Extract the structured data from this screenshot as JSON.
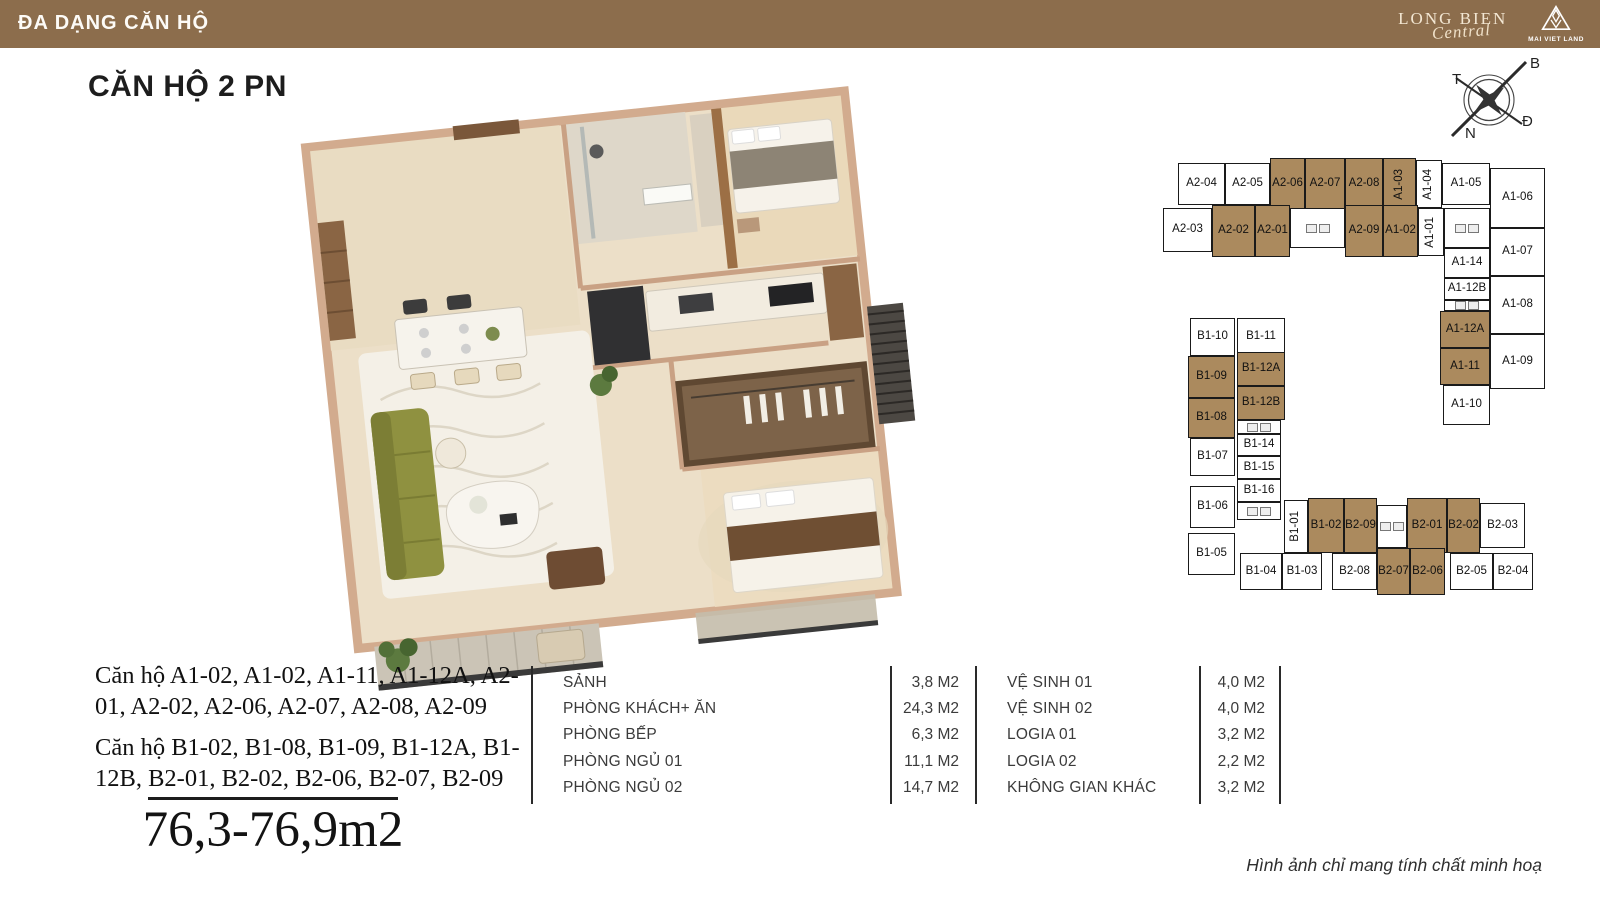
{
  "header": {
    "title": "ĐA DẠNG CĂN HỘ",
    "logo": {
      "line1": "LONG BIEN",
      "line2": "Central",
      "brand": "MAI VIET LAND"
    }
  },
  "page": {
    "title": "CĂN HỘ 2 PN",
    "area_range": "76,3-76,9m2",
    "disclaimer": "Hình ảnh chỉ mang tính chất minh hoạ"
  },
  "unit_groups": [
    {
      "text": "Căn hộ A1-02, A1-02, A1-11, A1-12A, A2-01, A2-02, A2-06, A2-07, A2-08, A2-09"
    },
    {
      "text": "Căn hộ B1-02, B1-08, B1-09, B1-12A, B1-12B, B2-01, B2-02, B2-06, B2-07, B2-09"
    }
  ],
  "compass": {
    "top": "B",
    "left": "T",
    "bottom": "N",
    "right": "Đ"
  },
  "room_table": {
    "left": [
      {
        "label": "SẢNH",
        "area": "3,8 M2"
      },
      {
        "label": "PHÒNG KHÁCH+ ĂN",
        "area": "24,3 M2"
      },
      {
        "label": "PHÒNG BẾP",
        "area": "6,3 M2"
      },
      {
        "label": "PHÒNG NGỦ 01",
        "area": "11,1 M2"
      },
      {
        "label": "PHÒNG NGỦ 02",
        "area": "14,7 M2"
      }
    ],
    "right": [
      {
        "label": "VỆ SINH 01",
        "area": "4,0 M2"
      },
      {
        "label": "VỆ SINH 02",
        "area": "4,0 M2"
      },
      {
        "label": "LOGIA 01",
        "area": "3,2 M2"
      },
      {
        "label": "LOGIA 02",
        "area": "2,2 M2"
      },
      {
        "label": "KHÔNG GIAN KHÁC",
        "area": "3,2 M2"
      }
    ]
  },
  "colors": {
    "header_bg": "#8c6d4c",
    "unit_highlight": "#ab8a5e",
    "unit_border": "#1a1a1a"
  },
  "floorplate": {
    "highlight_color": "#ab8a5e",
    "units": [
      {
        "label": "A2-04",
        "x": 28,
        "y": 13,
        "w": 47,
        "h": 42
      },
      {
        "label": "A2-05",
        "x": 75,
        "y": 13,
        "w": 45,
        "h": 42
      },
      {
        "label": "A2-06",
        "x": 120,
        "y": 8,
        "w": 35,
        "h": 52,
        "hl": true
      },
      {
        "label": "A2-07",
        "x": 155,
        "y": 8,
        "w": 40,
        "h": 52,
        "hl": true
      },
      {
        "label": "A2-08",
        "x": 195,
        "y": 8,
        "w": 38,
        "h": 52,
        "hl": true
      },
      {
        "label": "A1-03",
        "x": 233,
        "y": 8,
        "w": 33,
        "h": 52,
        "hl": true,
        "v": true
      },
      {
        "label": "A1-04",
        "x": 266,
        "y": 10,
        "w": 26,
        "h": 48,
        "v": true
      },
      {
        "label": "A1-05",
        "x": 292,
        "y": 13,
        "w": 48,
        "h": 42
      },
      {
        "label": "A2-03",
        "x": 13,
        "y": 58,
        "w": 49,
        "h": 44
      },
      {
        "label": "A2-02",
        "x": 62,
        "y": 55,
        "w": 43,
        "h": 52,
        "hl": true
      },
      {
        "label": "A2-01",
        "x": 105,
        "y": 55,
        "w": 35,
        "h": 52,
        "hl": true
      },
      {
        "label": "",
        "x": 140,
        "y": 58,
        "w": 55,
        "h": 40,
        "core": true
      },
      {
        "label": "A2-09",
        "x": 195,
        "y": 55,
        "w": 38,
        "h": 52,
        "hl": true
      },
      {
        "label": "A1-02",
        "x": 233,
        "y": 55,
        "w": 35,
        "h": 52,
        "hl": true
      },
      {
        "label": "A1-01",
        "x": 268,
        "y": 58,
        "w": 26,
        "h": 48,
        "v": true
      },
      {
        "label": "",
        "x": 294,
        "y": 58,
        "w": 46,
        "h": 40,
        "core": true
      },
      {
        "label": "A1-06",
        "x": 340,
        "y": 18,
        "w": 55,
        "h": 60
      },
      {
        "label": "A1-07",
        "x": 340,
        "y": 78,
        "w": 55,
        "h": 48
      },
      {
        "label": "A1-14",
        "x": 294,
        "y": 98,
        "w": 46,
        "h": 30
      },
      {
        "label": "A1-12B",
        "x": 294,
        "y": 128,
        "w": 46,
        "h": 22
      },
      {
        "label": "A1-08",
        "x": 340,
        "y": 126,
        "w": 55,
        "h": 58
      },
      {
        "label": "",
        "x": 294,
        "y": 150,
        "w": 46,
        "h": 11,
        "core": true
      },
      {
        "label": "A1-12A",
        "x": 290,
        "y": 161,
        "w": 50,
        "h": 37,
        "hl": true
      },
      {
        "label": "A1-11",
        "x": 290,
        "y": 198,
        "w": 50,
        "h": 37,
        "hl": true
      },
      {
        "label": "A1-09",
        "x": 340,
        "y": 184,
        "w": 55,
        "h": 55
      },
      {
        "label": "A1-10",
        "x": 293,
        "y": 235,
        "w": 47,
        "h": 40
      },
      {
        "label": "B1-10",
        "x": 40,
        "y": 168,
        "w": 45,
        "h": 38
      },
      {
        "label": "B1-11",
        "x": 87,
        "y": 168,
        "w": 48,
        "h": 38
      },
      {
        "label": "B1-09",
        "x": 38,
        "y": 206,
        "w": 47,
        "h": 42,
        "hl": true
      },
      {
        "label": "B1-12A",
        "x": 87,
        "y": 202,
        "w": 48,
        "h": 34,
        "hl": true
      },
      {
        "label": "B1-12B",
        "x": 87,
        "y": 236,
        "w": 48,
        "h": 34,
        "hl": true
      },
      {
        "label": "B1-08",
        "x": 38,
        "y": 248,
        "w": 47,
        "h": 40,
        "hl": true
      },
      {
        "label": "",
        "x": 87,
        "y": 270,
        "w": 44,
        "h": 14,
        "core": true
      },
      {
        "label": "B1-07",
        "x": 40,
        "y": 288,
        "w": 45,
        "h": 38
      },
      {
        "label": "B1-14",
        "x": 87,
        "y": 284,
        "w": 44,
        "h": 22
      },
      {
        "label": "B1-15",
        "x": 87,
        "y": 306,
        "w": 44,
        "h": 23
      },
      {
        "label": "B1-16",
        "x": 87,
        "y": 329,
        "w": 44,
        "h": 23
      },
      {
        "label": "B1-06",
        "x": 40,
        "y": 336,
        "w": 45,
        "h": 42
      },
      {
        "label": "",
        "x": 87,
        "y": 352,
        "w": 44,
        "h": 18,
        "core": true
      },
      {
        "label": "B1-05",
        "x": 38,
        "y": 383,
        "w": 47,
        "h": 42
      },
      {
        "label": "B1-01",
        "x": 134,
        "y": 350,
        "w": 24,
        "h": 53,
        "v": true
      },
      {
        "label": "B1-02",
        "x": 158,
        "y": 348,
        "w": 36,
        "h": 55,
        "hl": true
      },
      {
        "label": "B2-09",
        "x": 194,
        "y": 348,
        "w": 33,
        "h": 55,
        "hl": true
      },
      {
        "label": "",
        "x": 227,
        "y": 355,
        "w": 30,
        "h": 43,
        "core": true
      },
      {
        "label": "B2-01",
        "x": 257,
        "y": 348,
        "w": 40,
        "h": 55,
        "hl": true
      },
      {
        "label": "B2-02",
        "x": 297,
        "y": 348,
        "w": 33,
        "h": 55,
        "hl": true
      },
      {
        "label": "B2-03",
        "x": 330,
        "y": 353,
        "w": 45,
        "h": 45
      },
      {
        "label": "B1-04",
        "x": 90,
        "y": 403,
        "w": 42,
        "h": 37
      },
      {
        "label": "B1-03",
        "x": 132,
        "y": 403,
        "w": 40,
        "h": 37
      },
      {
        "label": "B2-08",
        "x": 182,
        "y": 403,
        "w": 45,
        "h": 37
      },
      {
        "label": "B2-07",
        "x": 227,
        "y": 398,
        "w": 33,
        "h": 47,
        "hl": true
      },
      {
        "label": "B2-06",
        "x": 260,
        "y": 398,
        "w": 35,
        "h": 47,
        "hl": true
      },
      {
        "label": "B2-05",
        "x": 300,
        "y": 403,
        "w": 43,
        "h": 37
      },
      {
        "label": "B2-04",
        "x": 343,
        "y": 403,
        "w": 40,
        "h": 37
      }
    ]
  }
}
